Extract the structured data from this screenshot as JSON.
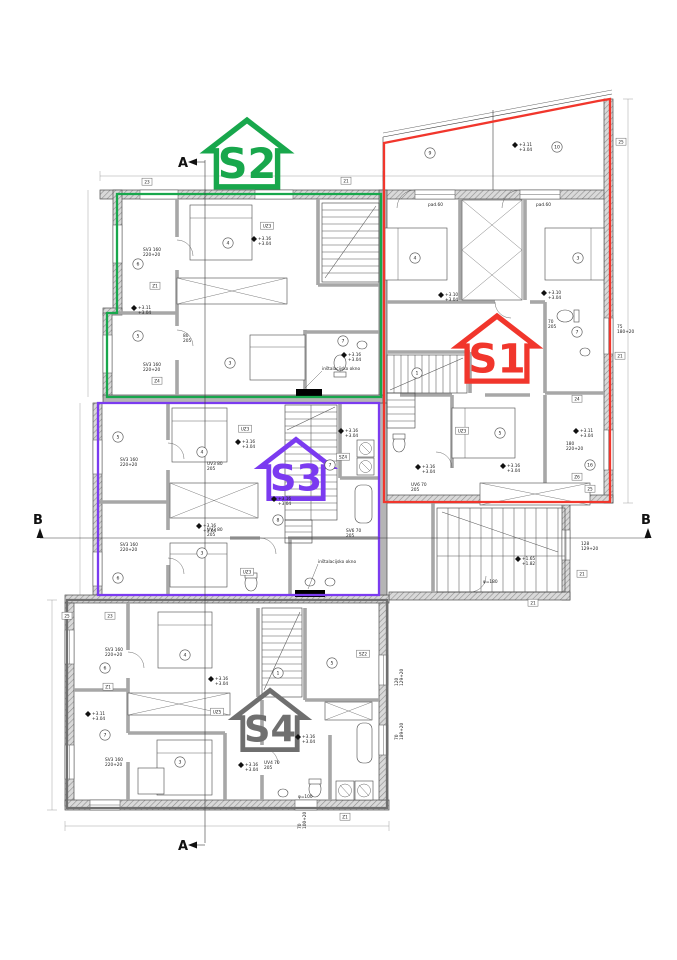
{
  "page": {
    "background": "#ffffff"
  },
  "units": [
    {
      "id": "S1",
      "label": "S1",
      "color": "#f1362c"
    },
    {
      "id": "S2",
      "label": "S2",
      "color": "#18a74c"
    },
    {
      "id": "S3",
      "label": "S3",
      "color": "#7b3bf0"
    },
    {
      "id": "S4",
      "label": "S4",
      "color": "#6f6f6f"
    }
  ],
  "sections": {
    "a": "A",
    "b": "B"
  },
  "annotations": [
    {
      "x": 138,
      "y": 309,
      "t": "+3.11|+3.04",
      "e": 1
    },
    {
      "x": 258,
      "y": 240,
      "t": "+3.16|+3.04",
      "e": 1
    },
    {
      "x": 348,
      "y": 356,
      "t": "+3.16|+3.04",
      "e": 1
    },
    {
      "x": 519,
      "y": 146,
      "t": "+3.11|+3.04",
      "e": 1
    },
    {
      "x": 548,
      "y": 294,
      "t": "+3.10|+3.04",
      "e": 1
    },
    {
      "x": 445,
      "y": 296,
      "t": "+3.10|+3.04",
      "e": 1
    },
    {
      "x": 422,
      "y": 468,
      "t": "+3.16|+3.04",
      "e": 1
    },
    {
      "x": 507,
      "y": 467,
      "t": "+3.16|+3.04",
      "e": 1
    },
    {
      "x": 580,
      "y": 432,
      "t": "+3.11|+3.04",
      "e": 1
    },
    {
      "x": 345,
      "y": 432,
      "t": "+3.16|+3.04",
      "e": 1
    },
    {
      "x": 242,
      "y": 443,
      "t": "+3.16|+3.04",
      "e": 1
    },
    {
      "x": 278,
      "y": 500,
      "t": "+3.16|+3.04",
      "e": 1
    },
    {
      "x": 203,
      "y": 527,
      "t": "+3.16|+3.04",
      "e": 1
    },
    {
      "x": 92,
      "y": 715,
      "t": "+3.11|+3.04",
      "e": 1
    },
    {
      "x": 215,
      "y": 680,
      "t": "+3.16|+3.04",
      "e": 1
    },
    {
      "x": 302,
      "y": 738,
      "t": "+3.16|+3.04",
      "e": 1
    },
    {
      "x": 245,
      "y": 766,
      "t": "+3.16|+3.04",
      "e": 1
    },
    {
      "x": 522,
      "y": 560,
      "t": "+1.65|+1.82",
      "e": 1
    },
    {
      "x": 143,
      "y": 251,
      "t": "SV3 160|220+20"
    },
    {
      "x": 143,
      "y": 366,
      "t": "SV3 160|220+20"
    },
    {
      "x": 120,
      "y": 461,
      "t": "SV3 160|220+20"
    },
    {
      "x": 120,
      "y": 546,
      "t": "SV3 160|220+20"
    },
    {
      "x": 105,
      "y": 651,
      "t": "SV3 160|220+20"
    },
    {
      "x": 105,
      "y": 761,
      "t": "SV3 160|220+20"
    },
    {
      "x": 617,
      "y": 328,
      "t": "75|180+20"
    },
    {
      "x": 566,
      "y": 445,
      "t": "180|220+20"
    },
    {
      "x": 581,
      "y": 545,
      "t": "128|129+20"
    },
    {
      "x": 398,
      "y": 686,
      "t": "120|129+20",
      "r": -90
    },
    {
      "x": 398,
      "y": 740,
      "t": "70|189+20",
      "r": -90
    },
    {
      "x": 301,
      "y": 829,
      "t": "70|100+20",
      "r": -90
    },
    {
      "x": 428,
      "y": 206,
      "t": "pad.60"
    },
    {
      "x": 536,
      "y": 206,
      "t": "pad.60"
    },
    {
      "x": 183,
      "y": 337,
      "t": "80|205"
    },
    {
      "x": 207,
      "y": 465,
      "t": "UV3 80|205"
    },
    {
      "x": 207,
      "y": 531,
      "t": "UV3 80|205"
    },
    {
      "x": 411,
      "y": 486,
      "t": "UV6 70|205"
    },
    {
      "x": 548,
      "y": 323,
      "t": "70|205"
    },
    {
      "x": 346,
      "y": 532,
      "t": "SV6 70|205"
    },
    {
      "x": 264,
      "y": 764,
      "t": "UV4 70|205"
    },
    {
      "x": 322,
      "y": 370,
      "t": "inštalacijsko okno"
    },
    {
      "x": 318,
      "y": 563,
      "t": "inštalacijsko okno"
    },
    {
      "x": 298,
      "y": 798,
      "t": "φ=100"
    },
    {
      "x": 483,
      "y": 583,
      "t": "φ=180"
    }
  ],
  "boxed_labels": [
    {
      "x": 147,
      "y": 183,
      "t": "23"
    },
    {
      "x": 346,
      "y": 182,
      "t": "21"
    },
    {
      "x": 621,
      "y": 143,
      "t": "25"
    },
    {
      "x": 620,
      "y": 357,
      "t": "21"
    },
    {
      "x": 155,
      "y": 287,
      "t": "Z1"
    },
    {
      "x": 157,
      "y": 382,
      "t": "Z4"
    },
    {
      "x": 577,
      "y": 400,
      "t": "24"
    },
    {
      "x": 577,
      "y": 478,
      "t": "Z6"
    },
    {
      "x": 590,
      "y": 490,
      "t": "25"
    },
    {
      "x": 67,
      "y": 617,
      "t": "25"
    },
    {
      "x": 110,
      "y": 617,
      "t": "23"
    },
    {
      "x": 108,
      "y": 688,
      "t": "Z1"
    },
    {
      "x": 345,
      "y": 818,
      "t": "Z1"
    },
    {
      "x": 533,
      "y": 604,
      "t": "21"
    },
    {
      "x": 582,
      "y": 575,
      "t": "21"
    },
    {
      "x": 245,
      "y": 430,
      "t": "UZ3"
    },
    {
      "x": 247,
      "y": 573,
      "t": "UZ3"
    },
    {
      "x": 343,
      "y": 458,
      "t": "SZ4"
    },
    {
      "x": 462,
      "y": 432,
      "t": "UZ3"
    },
    {
      "x": 217,
      "y": 713,
      "t": "UZ5"
    },
    {
      "x": 363,
      "y": 655,
      "t": "SZ2"
    },
    {
      "x": 267,
      "y": 227,
      "t": "UZ3"
    }
  ],
  "room_numbers": [
    {
      "x": 138,
      "y": 264,
      "n": "6"
    },
    {
      "x": 138,
      "y": 336,
      "n": "5"
    },
    {
      "x": 228,
      "y": 243,
      "n": "4"
    },
    {
      "x": 230,
      "y": 363,
      "n": "3"
    },
    {
      "x": 343,
      "y": 341,
      "n": "7"
    },
    {
      "x": 430,
      "y": 153,
      "n": "9"
    },
    {
      "x": 557,
      "y": 147,
      "n": "10"
    },
    {
      "x": 415,
      "y": 258,
      "n": "4"
    },
    {
      "x": 578,
      "y": 258,
      "n": "3"
    },
    {
      "x": 577,
      "y": 332,
      "n": "7"
    },
    {
      "x": 417,
      "y": 373,
      "n": "1"
    },
    {
      "x": 500,
      "y": 433,
      "n": "5"
    },
    {
      "x": 590,
      "y": 465,
      "n": "16"
    },
    {
      "x": 118,
      "y": 437,
      "n": "5"
    },
    {
      "x": 118,
      "y": 578,
      "n": "6"
    },
    {
      "x": 202,
      "y": 452,
      "n": "4"
    },
    {
      "x": 202,
      "y": 553,
      "n": "3"
    },
    {
      "x": 330,
      "y": 465,
      "n": "7"
    },
    {
      "x": 278,
      "y": 520,
      "n": "8"
    },
    {
      "x": 105,
      "y": 668,
      "n": "6"
    },
    {
      "x": 105,
      "y": 735,
      "n": "7"
    },
    {
      "x": 185,
      "y": 655,
      "n": "4"
    },
    {
      "x": 180,
      "y": 762,
      "n": "3"
    },
    {
      "x": 332,
      "y": 663,
      "n": "5"
    },
    {
      "x": 278,
      "y": 673,
      "n": "1"
    }
  ]
}
